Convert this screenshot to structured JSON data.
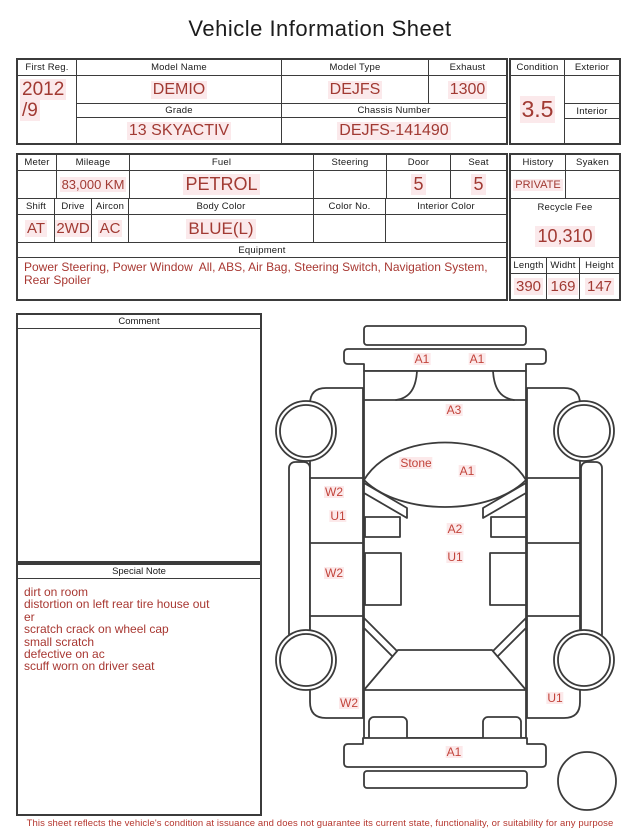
{
  "title": "Vehicle Information Sheet",
  "fields": {
    "first_reg": {
      "label": "First Reg.",
      "line1": "2012",
      "line2": "/9"
    },
    "model_name": {
      "label": "Model Name",
      "value": "DEMIO"
    },
    "model_type": {
      "label": "Model Type",
      "value": "DEJFS"
    },
    "exhaust": {
      "label": "Exhaust",
      "value": "1300"
    },
    "grade": {
      "label": "Grade",
      "value": "13 SKYACTIV"
    },
    "chassis_number": {
      "label": "Chassis Number",
      "value": "DEJFS-141490"
    },
    "condition": {
      "label": "Condition",
      "value": "3.5"
    },
    "exterior": {
      "label": "Exterior",
      "value": ""
    },
    "interior": {
      "label": "Interior",
      "value": ""
    },
    "meter": {
      "label": "Meter",
      "value": ""
    },
    "mileage": {
      "label": "Mileage",
      "value": "83,000 KM"
    },
    "fuel": {
      "label": "Fuel",
      "value": "PETROL"
    },
    "steering": {
      "label": "Steering",
      "value": ""
    },
    "door": {
      "label": "Door",
      "value": "5"
    },
    "seat": {
      "label": "Seat",
      "value": "5"
    },
    "shift": {
      "label": "Shift",
      "value": "AT"
    },
    "drive": {
      "label": "Drive",
      "value": "2WD"
    },
    "aircon": {
      "label": "Aircon",
      "value": "AC"
    },
    "body_color": {
      "label": "Body Color",
      "value": "BLUE(L)"
    },
    "color_no": {
      "label": "Color No.",
      "value": ""
    },
    "interior_color": {
      "label": "Interior Color",
      "value": ""
    },
    "equipment": {
      "label": "Equipment",
      "value": "Power Steering, Power Window  All, ABS, Air Bag, Steering Switch, Navigation System, Rear Spoiler"
    },
    "history": {
      "label": "History",
      "value": "PRIVATE"
    },
    "syaken": {
      "label": "Syaken",
      "value": ""
    },
    "recycle_fee": {
      "label": "Recycle Fee",
      "value": "10,310"
    },
    "length": {
      "label": "Length",
      "value": "390"
    },
    "width": {
      "label": "Widht",
      "value": "169"
    },
    "height": {
      "label": "Height",
      "value": "147"
    }
  },
  "comment": {
    "label": "Comment",
    "value": ""
  },
  "special_note": {
    "label": "Special Note",
    "lines": [
      "dirt on room",
      "distortion on left rear tire house out",
      "er",
      "scratch crack on wheel cap",
      "small scratch",
      "defective on ac",
      "scuff worn on driver seat"
    ]
  },
  "diagram": {
    "labels": [
      {
        "text": "A1",
        "location": "front-bumper-left"
      },
      {
        "text": "A1",
        "location": "front-bumper-right"
      },
      {
        "text": "A3",
        "location": "hood-front"
      },
      {
        "text": "Stone",
        "location": "windshield-left"
      },
      {
        "text": "A1",
        "location": "windshield-center"
      },
      {
        "text": "W2",
        "location": "left-front-door-upper"
      },
      {
        "text": "U1",
        "location": "left-front-door-lower"
      },
      {
        "text": "A2",
        "location": "roof-center"
      },
      {
        "text": "U1",
        "location": "roof-center-lower"
      },
      {
        "text": "W2",
        "location": "left-rear-door"
      },
      {
        "text": "W2",
        "location": "left-rear-fender"
      },
      {
        "text": "U1",
        "location": "right-rear-fender"
      },
      {
        "text": "A1",
        "location": "rear-bumper"
      }
    ]
  },
  "disclaimer": "This sheet reflects the vehicle's condition at issuance and does not guarantee its current state, functionality, or suitability for any purpose",
  "colors": {
    "value_red": "#a13a33",
    "diagram_label_red": "#c2443b",
    "highlight_pink": "#fbe9eb",
    "border_dark": "#3b3b3b"
  }
}
